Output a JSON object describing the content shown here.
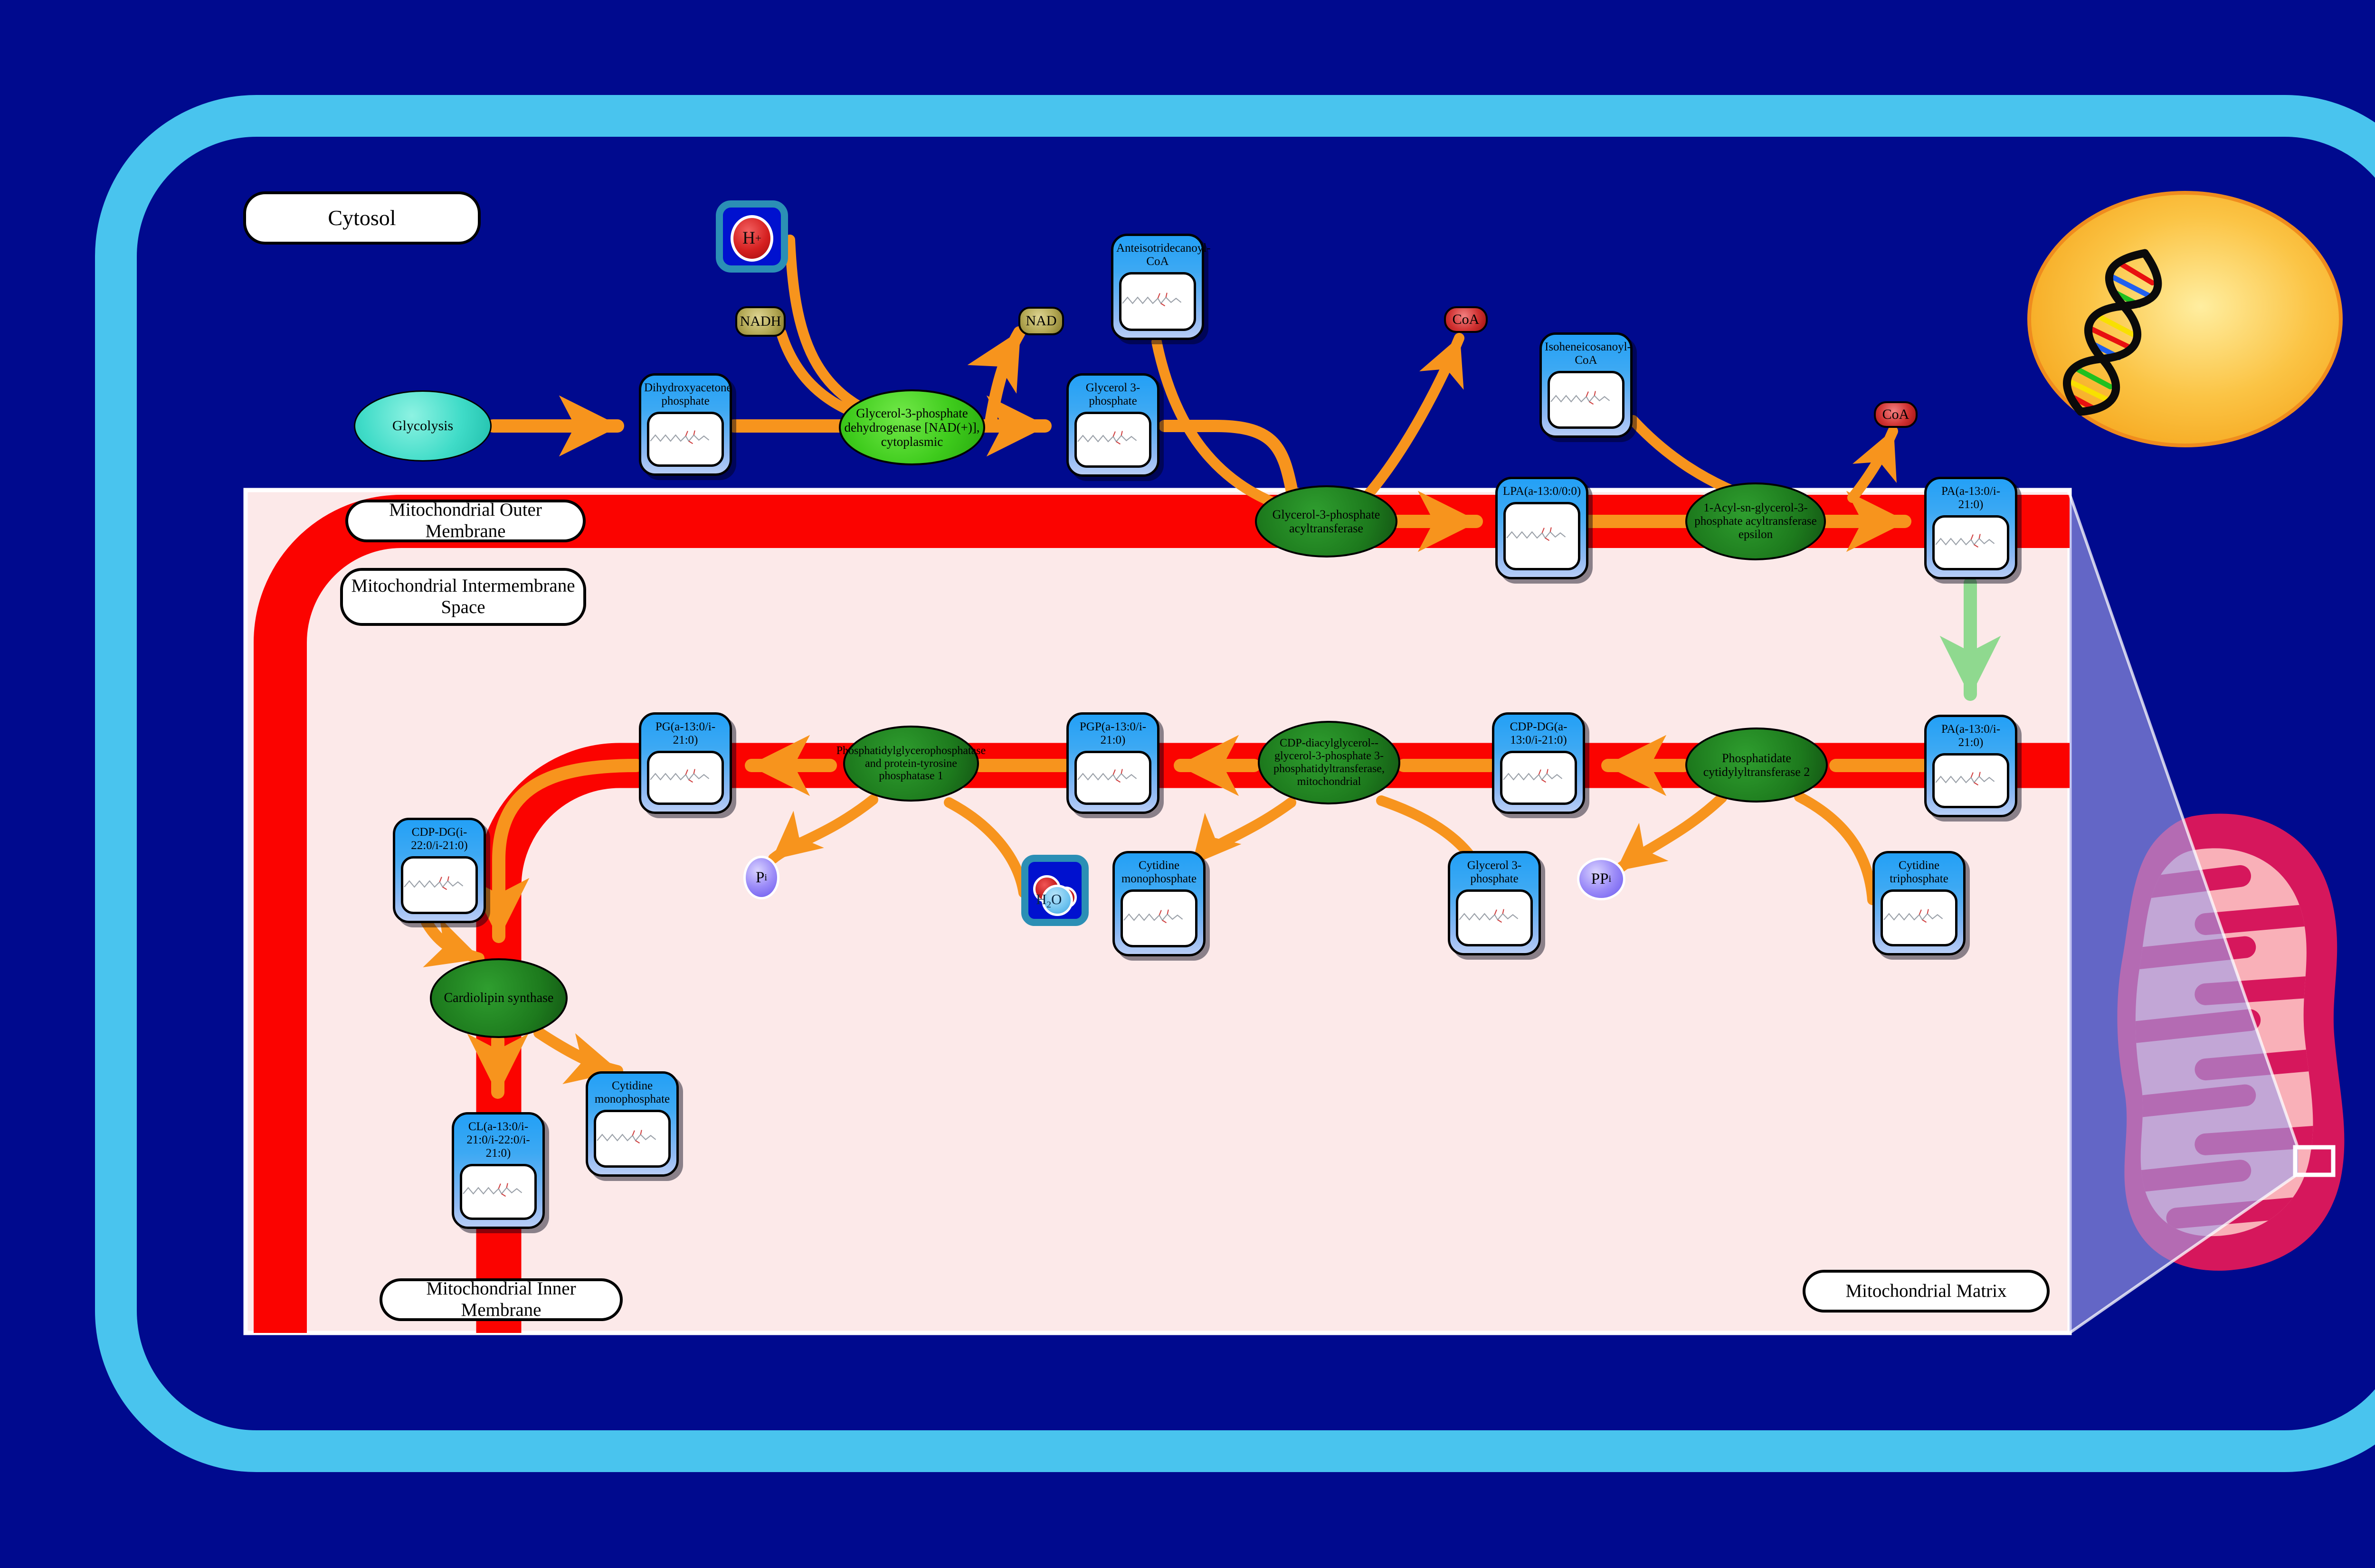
{
  "compartments": {
    "cytosol": "Cytosol",
    "outer_membrane": "Mitochondrial Outer Membrane",
    "intermembrane_space": "Mitochondrial Intermembrane Space",
    "inner_membrane": "Mitochondrial Inner Membrane",
    "matrix": "Mitochondrial Matrix"
  },
  "nodes": {
    "glycolysis": {
      "label": "Glycolysis"
    },
    "dhap": {
      "label": "Dihydroxyacetone phosphate"
    },
    "gpd1": {
      "label": "Glycerol-3-phosphate dehydrogenase [NAD(+)], cytoplasmic"
    },
    "g3p": {
      "label": "Glycerol 3-phosphate"
    },
    "anteisotridecanoyl_coa": {
      "label": "Anteisotridecanoyl-CoA"
    },
    "isoheneicosanoyl_coa": {
      "label": "Isoheneicosanoyl-CoA"
    },
    "coa": {
      "label": "CoA"
    },
    "nadh": {
      "label": "NADH"
    },
    "nad": {
      "label": "NAD"
    },
    "h_plus": {
      "main": "H",
      "sup": "+"
    },
    "h2o": {
      "h": "H",
      "sub": "2",
      "o": "O"
    },
    "gpat": {
      "label": "Glycerol-3-phosphate acyltransferase"
    },
    "lpa": {
      "label": "LPA(a-13:0/0:0)"
    },
    "agpat_epsilon": {
      "label": "1-Acyl-sn-glycerol-3-phosphate acyltransferase epsilon"
    },
    "pa": {
      "label": "PA(a-13:0/i-21:0)"
    },
    "cds2": {
      "label": "Phosphatidate cytidylyltransferase 2"
    },
    "ctp": {
      "label": "Cytidine triphosphate"
    },
    "ppi": {
      "main": "PP",
      "sub": "i"
    },
    "pi": {
      "main": "P",
      "sub": "i"
    },
    "cdp_dg_a": {
      "label": "CDP-DG(a-13:0/i-21:0)"
    },
    "cgs": {
      "label": "CDP-diacylglycerol--glycerol-3-phosphate 3-phosphatidyltransferase, mitochondrial"
    },
    "pgp": {
      "label": "PGP(a-13:0/i-21:0)"
    },
    "ptpmt1": {
      "label": "Phosphatidylglycerophosphatase and protein-tyrosine phosphatase 1"
    },
    "pg": {
      "label": "PG(a-13:0/i-21:0)"
    },
    "cdp_dg_i": {
      "label": "CDP-DG(i-22:0/i-21:0)"
    },
    "cls": {
      "label": "Cardiolipin synthase"
    },
    "cl": {
      "label": "CL(a-13:0/i-21:0/i-22:0/i-21:0)"
    },
    "cmp": {
      "label": "Cytidine monophosphate"
    }
  },
  "colors": {
    "background_navy": "#000a8e",
    "cell_border_cyan": "#49c4ee",
    "membrane_red": "#fb0300",
    "matrix_pink": "#fce9e9",
    "metabolite_blue": "#23a0f6",
    "enzyme_green": "#1d7a1d",
    "enzyme_bright_green": "#3ecb1c",
    "arrow_orange": "#f7941d",
    "arrow_green": "#8fd98f",
    "nucleus_yellow": "#f7a81c",
    "mitochondrion_crimson": "#d6175c"
  }
}
